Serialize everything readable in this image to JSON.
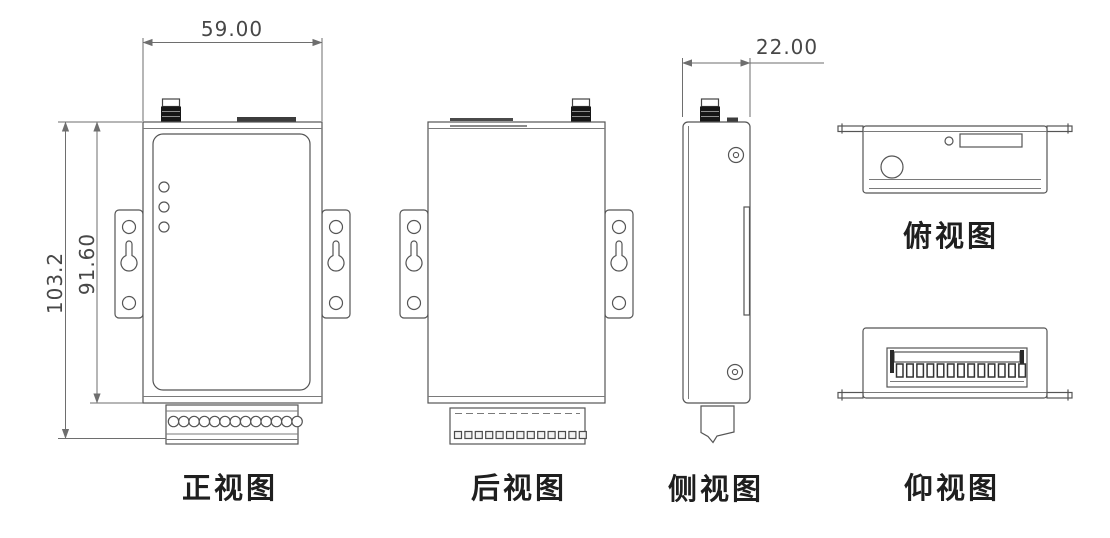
{
  "canvas": {
    "width": 1110,
    "height": 538,
    "background": "#ffffff"
  },
  "drawing": {
    "description": "Orthographic projection views of an industrial wireless device enclosure",
    "dimensions": {
      "width": "59.00",
      "overall_height": "103.2",
      "body_height": "91.60",
      "depth": "22.00"
    },
    "views": {
      "front": {
        "label": "正视图",
        "led_count": 3,
        "terminal_hole_count": 13
      },
      "rear": {
        "label": "后视图",
        "terminal_pin_count": 13
      },
      "side": {
        "label": "侧视图"
      },
      "top": {
        "label": "俯视图"
      },
      "bottom": {
        "label": "仰视图",
        "terminal_slot_count": 13
      }
    },
    "colors": {
      "line": "#555555",
      "dim_line": "#6e6e6e",
      "text": "#474747",
      "label_text": "#1f1f1f",
      "antenna_fill": "#161616"
    }
  }
}
